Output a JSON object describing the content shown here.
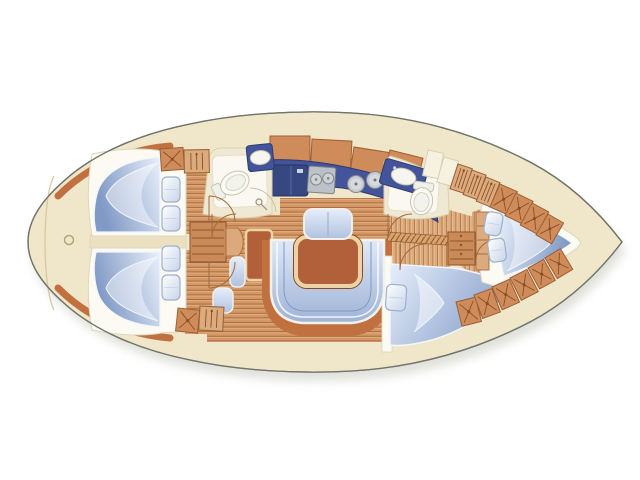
{
  "title": "Sailing yacht interior layout floor plan, bow to the right",
  "diagram": {
    "type": "yacht-interior-floor-plan",
    "orientation": {
      "bow": "right",
      "stern": "left"
    },
    "rooms": [
      {
        "id": "stern-deck",
        "label": "stern swim deck"
      },
      {
        "id": "aft-cabin-port",
        "label": "aft double cabin port"
      },
      {
        "id": "aft-cabin-starboard",
        "label": "aft double cabin starboard"
      },
      {
        "id": "companionway",
        "label": "companionway steps"
      },
      {
        "id": "nav-station",
        "label": "chart table with seat"
      },
      {
        "id": "aft-head",
        "label": "aft head with WC, basin, shower"
      },
      {
        "id": "galley",
        "label": "galley with fridge, stove, twin sinks"
      },
      {
        "id": "saloon",
        "label": "saloon with table, U-settee, bench sofa"
      },
      {
        "id": "forward-head",
        "label": "forward head with WC and basin"
      },
      {
        "id": "forward-cabin-starboard",
        "label": "forward double cabin starboard"
      },
      {
        "id": "owners-cabin",
        "label": "bow V-berth cabin"
      },
      {
        "id": "bow-tip",
        "label": "anchor locker"
      }
    ],
    "furniture_counts": {
      "berths": 4,
      "pillows": 7,
      "toilets": 2,
      "basins": 2,
      "round_sinks": 2,
      "stove_burners": 2,
      "hull_lockers_x": 12,
      "hull_lockers_rail": 5
    },
    "lockers_x": [
      {
        "x": 160,
        "y": 149,
        "w": 23,
        "h": 22,
        "r": -4
      },
      {
        "x": 178,
        "y": 308,
        "w": 22,
        "h": 23,
        "r": 6
      },
      {
        "x": 500,
        "y": 184,
        "w": 19,
        "h": 25,
        "r": 24
      },
      {
        "x": 516,
        "y": 193,
        "w": 19,
        "h": 25,
        "r": 26
      },
      {
        "x": 532,
        "y": 203,
        "w": 19,
        "h": 25,
        "r": 28
      },
      {
        "x": 548,
        "y": 214,
        "w": 18,
        "h": 24,
        "r": 30
      },
      {
        "x": 456,
        "y": 302,
        "w": 20,
        "h": 25,
        "r": -14
      },
      {
        "x": 474,
        "y": 295,
        "w": 19,
        "h": 25,
        "r": -20
      },
      {
        "x": 492,
        "y": 287,
        "w": 19,
        "h": 25,
        "r": -24
      },
      {
        "x": 510,
        "y": 278,
        "w": 19,
        "h": 25,
        "r": -27
      },
      {
        "x": 528,
        "y": 268,
        "w": 18,
        "h": 24,
        "r": -29
      },
      {
        "x": 545,
        "y": 258,
        "w": 18,
        "h": 24,
        "r": -31
      }
    ],
    "lockers_rail": [
      {
        "x": 184,
        "y": 150,
        "w": 25,
        "h": 23,
        "r": -1
      },
      {
        "x": 200,
        "y": 306,
        "w": 24,
        "h": 24,
        "r": 3
      },
      {
        "x": 458,
        "y": 164,
        "w": 15,
        "h": 26,
        "r": 18
      },
      {
        "x": 472,
        "y": 170,
        "w": 15,
        "h": 26,
        "r": 20
      },
      {
        "x": 486,
        "y": 177,
        "w": 15,
        "h": 26,
        "r": 22
      }
    ],
    "pillows": [
      {
        "x": 162,
        "y": 177,
        "w": 18,
        "h": 25,
        "r": 0
      },
      {
        "x": 162,
        "y": 206,
        "w": 18,
        "h": 25,
        "r": 0
      },
      {
        "x": 162,
        "y": 246,
        "w": 18,
        "h": 25,
        "r": 0
      },
      {
        "x": 162,
        "y": 275,
        "w": 18,
        "h": 25,
        "r": 0
      },
      {
        "x": 387,
        "y": 284,
        "w": 20,
        "h": 26,
        "r": 4
      },
      {
        "x": 487,
        "y": 211,
        "w": 17,
        "h": 23,
        "r": 10
      },
      {
        "x": 487,
        "y": 240,
        "w": 17,
        "h": 23,
        "r": -8
      }
    ]
  },
  "colors": {
    "deck_cream": "#f0e7ca",
    "wall_cream": "#efe8d2",
    "white": "#fbfaf3",
    "outline": "#70756a",
    "trim": "#c0713f",
    "wood": "#c98a58",
    "wood_light": "#dcab7d",
    "navy": "#44549a",
    "navy_dark": "#37477f",
    "steel": "#bcc1c7",
    "table": "#b2603a",
    "table_trim": "#ecd2a4",
    "locker": "#cf8c5a",
    "locker_line": "#9a5f34",
    "landing": "#dca97c"
  }
}
